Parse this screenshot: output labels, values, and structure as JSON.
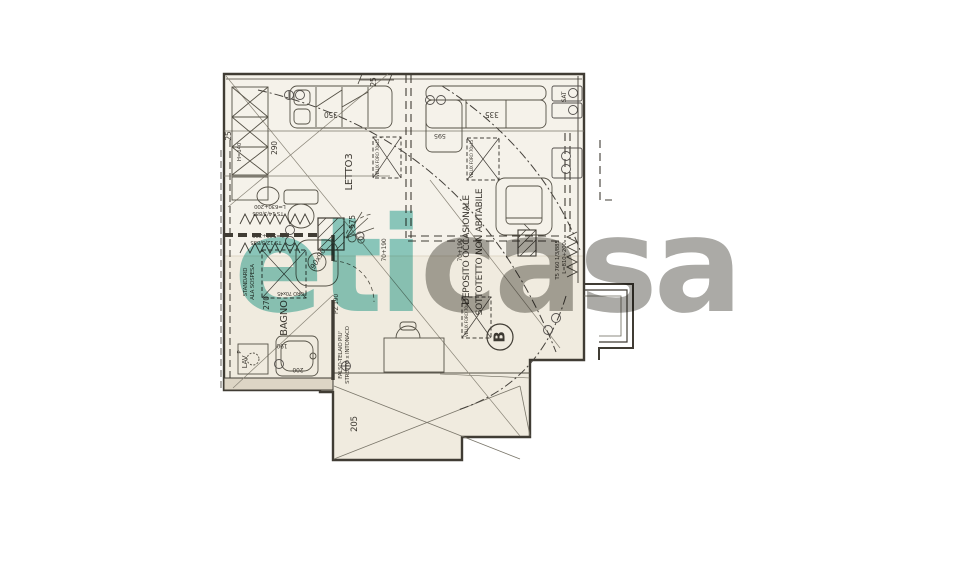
{
  "watermark": {
    "part1": "eti",
    "part2": "casa",
    "teal": "#8fd0ca",
    "gray": "#abaaa6"
  },
  "rooms": {
    "letto": "LETTO3",
    "bagno": "BAGNO",
    "deposito": "DEPOSITO  OCCASIONALE",
    "sottotetto": "SOTTOTETTO  NON ABITABILE",
    "lav": "LAV",
    "lav_p": "P",
    "sat": "SAT",
    "section_b": "B"
  },
  "dimensions": {
    "top_25": "25",
    "left_25": "25",
    "wardrobe_290": "290",
    "wardrobe_h": "H=140",
    "bed_350": "350",
    "sofa_335": "335",
    "win_595": "595",
    "diag_575": "575",
    "bath_270": "270",
    "tub_190": "190",
    "tub_200": "200",
    "low_205": "205",
    "pz_190": "PZ 190",
    "sill_a": "70+190",
    "sill_b": "70+190"
  },
  "annotations": {
    "rad1_l1": "L=630+200",
    "rad1_l2": "TS 14/3/885",
    "rad2_l1": "L=540+200",
    "rad2_l2": "TS 12/3/885",
    "rad3_l1": "L=810+200",
    "rad3_l2": "T5 760 1/3/885",
    "velux1": "VELUX FORO 70x45",
    "velux2": "VELUX FORO 70x45",
    "velux3": "VELUX FORO 70x45",
    "foro": "FORO 70x45",
    "shower": "90x90",
    "wc_l1": "STANDARD",
    "wc_l2": "ALA SOSPESA",
    "falso_l1": "FALSO-TELAIO PIU'",
    "falso_l2": "STRETTO x INTONACO"
  },
  "colors": {
    "paper": "#f0ebdf",
    "paper_light": "#f7f4ee",
    "wall": "#403c34",
    "thin": "#6a6659"
  }
}
